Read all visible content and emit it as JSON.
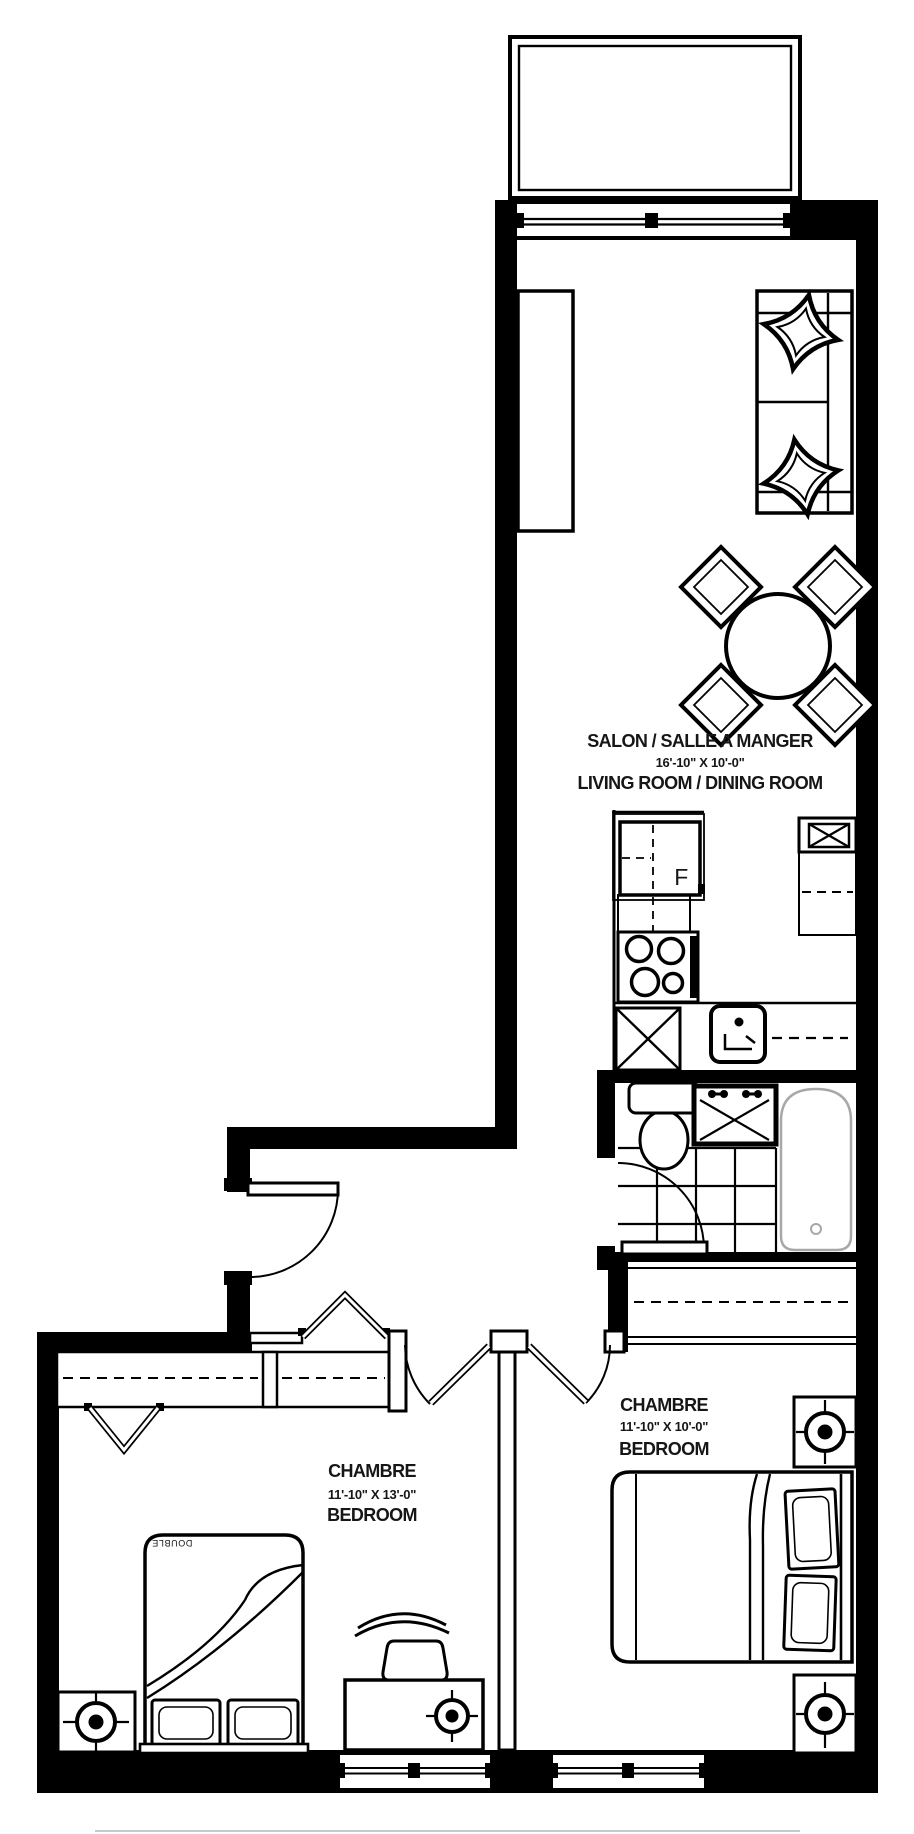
{
  "plan": {
    "type": "apartment-floor-plan",
    "colors": {
      "wall": "#000000",
      "line": "#111111",
      "tub_line": "#a8a8a8",
      "background": "#ffffff"
    },
    "rooms": {
      "living": {
        "name_fr": "SALON / SALLE A MANGER",
        "dims": "16'-10\" X 10'-0\"",
        "name_en": "LIVING ROOM  / DINING ROOM"
      },
      "bedroom_left": {
        "name_fr": "CHAMBRE",
        "dims": "11'-10\" X 13'-0\"",
        "name_en": "BEDROOM"
      },
      "bedroom_right": {
        "name_fr": "CHAMBRE",
        "dims": "11'-10\" X 10'-0\"",
        "name_en": "BEDROOM"
      }
    },
    "labels": {
      "fridge": "F",
      "bed_size": "DOUBLE"
    },
    "fixtures": [
      "balcony",
      "sliding-door",
      "sofa",
      "console",
      "dining-table",
      "dining-chairs",
      "fridge",
      "counters",
      "stove",
      "dishwasher",
      "kitchen-sink",
      "toilet",
      "vanity-sink",
      "bathtub",
      "tile-floor",
      "closets",
      "beds",
      "desk",
      "desk-chair",
      "ceiling-lights",
      "windows",
      "doors"
    ]
  }
}
